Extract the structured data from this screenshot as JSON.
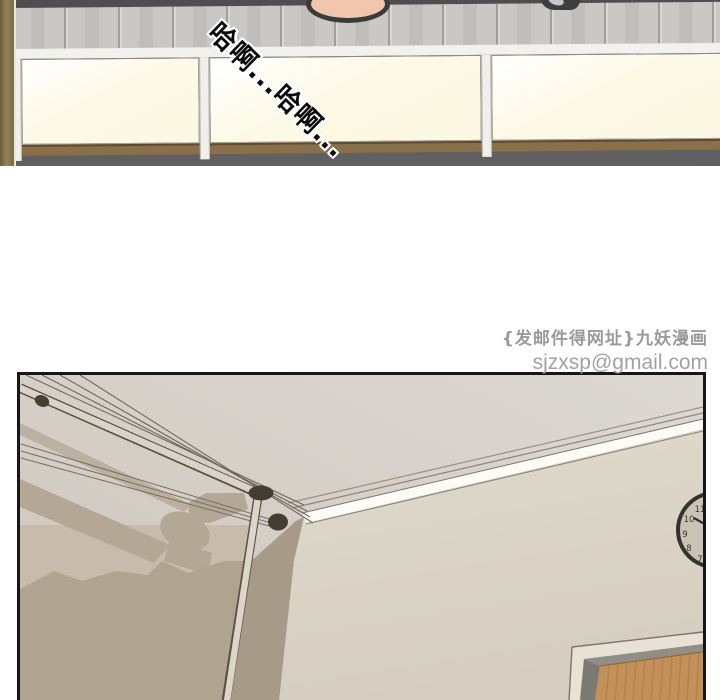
{
  "scene": {
    "panel1": {
      "sfx": "哈啊...哈啊...",
      "colors": {
        "background_dark": "#4e4e50",
        "tile_wall_gray": "#c9c8c4",
        "cabinet_cream": "#fbf8e3",
        "frame_white": "#f2f1ed",
        "wood_rail_brown": "#8a6f4b",
        "floor_gray": "#606062",
        "left_wall_brown": "#94835a",
        "skin": "#f2c6ad"
      }
    },
    "watermark": {
      "line1": "{发邮件得网址}九妖漫画",
      "line2": "sjzxsp@gmail.com"
    },
    "panel2": {
      "clock": {
        "numerals": [
          "11",
          "10",
          "9",
          "8",
          "7"
        ]
      },
      "colors": {
        "ceiling": "#d6d0c9",
        "shadow_tan": "#b5a795",
        "lower_wall_tan": "#b0a390",
        "corner_column": "#a79a88",
        "right_wall_cream": "#ddd7c9",
        "molding_white": "#fcfbf6",
        "pole_beige": "#dbd4c6",
        "mount_dark_brown": "#453d31",
        "door_wood": "#c4905a",
        "door_frame_gray": "#908e86",
        "clock_face": "#c9c3b6",
        "panel_border": "#171717"
      }
    }
  }
}
